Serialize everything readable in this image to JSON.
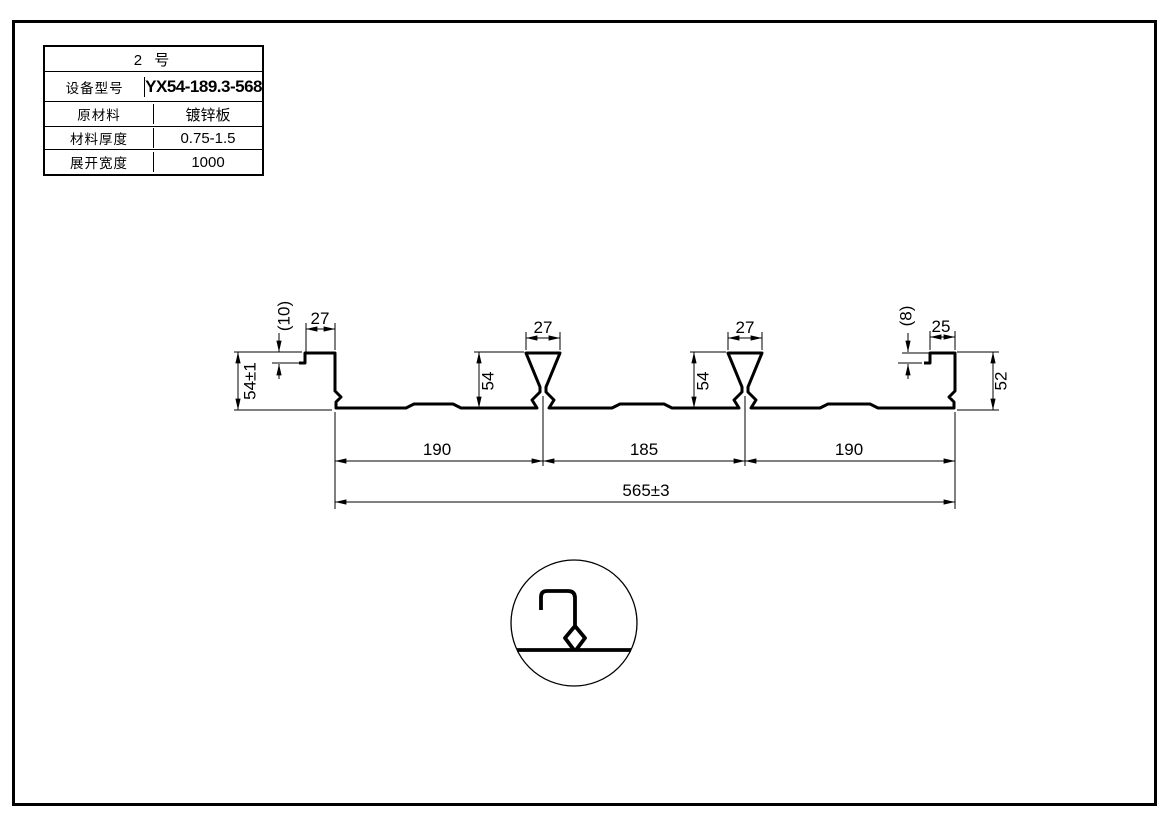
{
  "colors": {
    "ink": "#000000",
    "paper": "#ffffff"
  },
  "title_block": {
    "header": "2 号",
    "rows": [
      {
        "label": "设备型号",
        "value": "YX54-189.3-568"
      },
      {
        "label": "原材料",
        "value": "镀锌板"
      },
      {
        "label": "材料厚度",
        "value": "0.75-1.5"
      },
      {
        "label": "展开宽度",
        "value": "1000"
      }
    ]
  },
  "profile": {
    "dims": {
      "left_step": "(10)",
      "left_flange": "27",
      "left_height": "54±1",
      "rib1_width": "27",
      "rib1_height": "54",
      "rib2_width": "27",
      "rib2_height": "54",
      "right_step": "(8)",
      "right_flange": "25",
      "right_height": "52",
      "span_left": "190",
      "span_mid": "185",
      "span_right": "190",
      "overall": "565±3"
    }
  }
}
